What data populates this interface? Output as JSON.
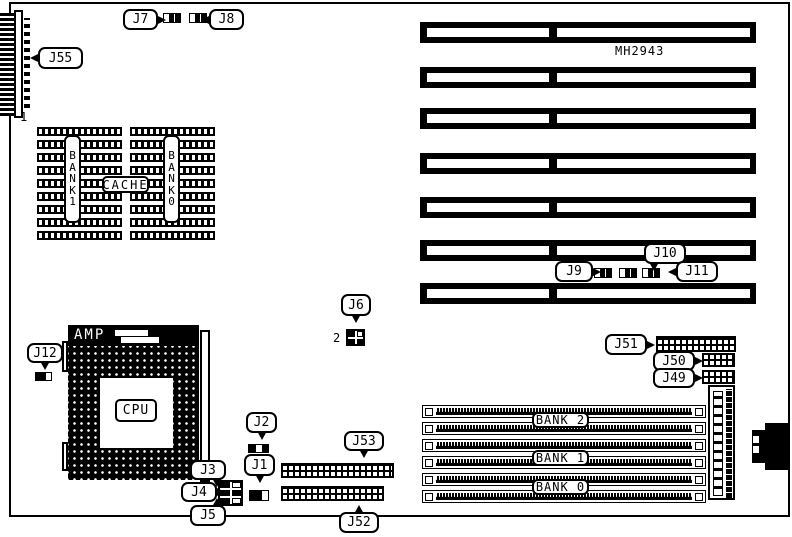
{
  "board": {
    "part_number": "MH2943",
    "j55_pin1_marker": "1",
    "j6_pin2_marker": "2"
  },
  "isa": {
    "slot_count": 7
  },
  "cache": {
    "label": "CACHE",
    "bank_left": "BANK 1",
    "bank_right": "BANK 0",
    "chip_rows_per_column": 9
  },
  "cpu": {
    "brand": "AMP",
    "label": "CPU"
  },
  "simm": {
    "socket_count": 6,
    "banks": [
      "BANK 2",
      "BANK 1",
      "BANK 0"
    ]
  },
  "labels": {
    "j1": "J1",
    "j2": "J2",
    "j3": "J3",
    "j4": "J4",
    "j5": "J5",
    "j6": "J6",
    "j7": "J7",
    "j8": "J8",
    "j9": "J9",
    "j10": "J10",
    "j11": "J11",
    "j12": "J12",
    "j49": "J49",
    "j50": "J50",
    "j51": "J51",
    "j52": "J52",
    "j53": "J53",
    "j55": "J55"
  }
}
